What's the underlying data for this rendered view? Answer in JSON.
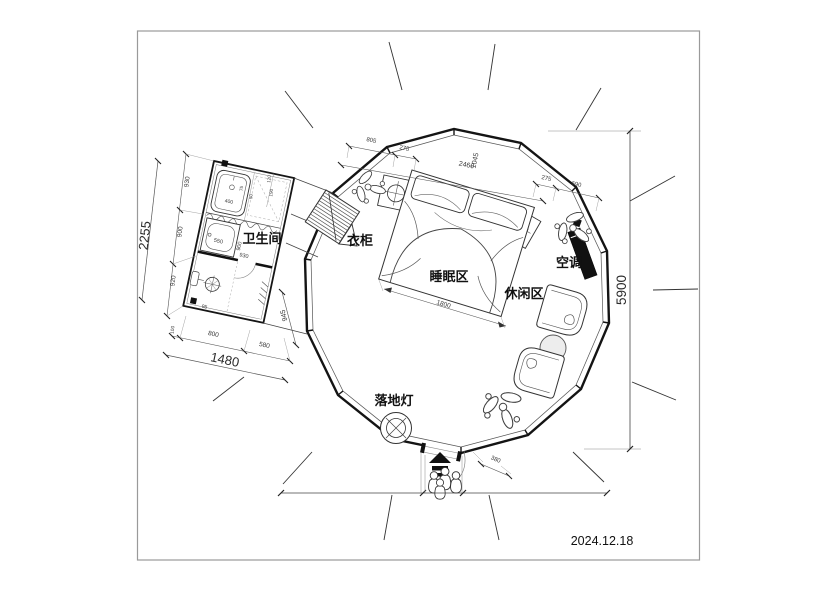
{
  "meta": {
    "date": "2024.12.18"
  },
  "labels": {
    "bathroom": "卫生间",
    "wardrobe": "衣柜",
    "sleeping_area": "睡眠区",
    "leisure_area": "休闲区",
    "air_conditioner": "空调",
    "floor_lamp": "落地灯"
  },
  "dims": {
    "height_total": "5900",
    "left_total": "2255",
    "left_seg_1": "930",
    "left_seg_2": "900",
    "left_seg_3": "920",
    "bottom_total": "1480",
    "bottom_seg_0": "100",
    "bottom_seg_1": "800",
    "bottom_seg_2": "580",
    "bath_diag": "945",
    "top_seg_1": "805",
    "top_seg_2": "275",
    "top_main": "2460",
    "top_cross": "1045",
    "right_seg_1": "275",
    "right_seg_2": "690",
    "bed_width": "1800",
    "entry_offset": "380",
    "bath_sink": "550",
    "bath_mid_h": "900",
    "bath_mid_w": "930",
    "bath_top": "400",
    "bath_t1": "75",
    "bath_t2": "50",
    "bath_t3": "120",
    "bath_t4": "190",
    "bath_toilet": "95"
  }
}
